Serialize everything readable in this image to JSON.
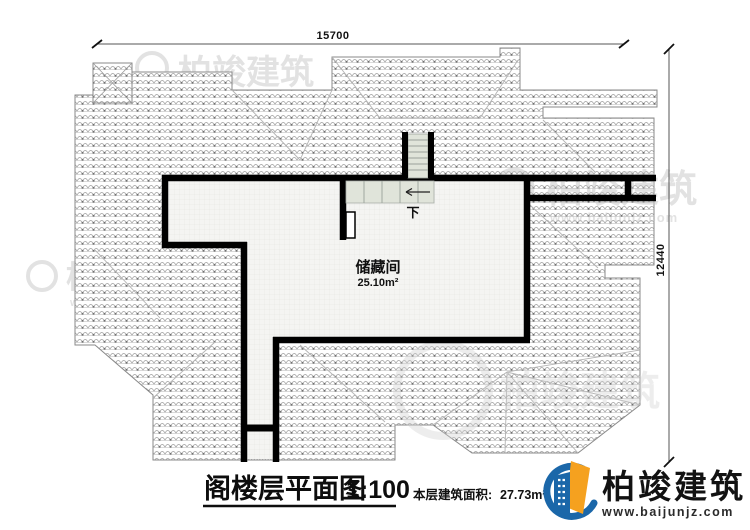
{
  "plan": {
    "room": {
      "name": "储藏间",
      "area": "25.10m²"
    },
    "stairs": {
      "down_label": "下"
    },
    "dimensions": {
      "top": "15700",
      "right": "12440"
    }
  },
  "titleblock": {
    "title": "阁楼层平面图",
    "scale": "1:100",
    "area_label": "本层建筑面积:",
    "area_value": "27.73m²"
  },
  "logo": {
    "name": "柏竣建筑",
    "url": "www.baijunjz.com"
  },
  "watermark": {
    "name": "柏竣建筑",
    "url": "www.baijunjz.com"
  },
  "colors": {
    "logo_blue": "#1b67a9",
    "logo_orange": "#f5a11f",
    "wall_black": "#000000",
    "stair_fill": "#e0e4da"
  }
}
